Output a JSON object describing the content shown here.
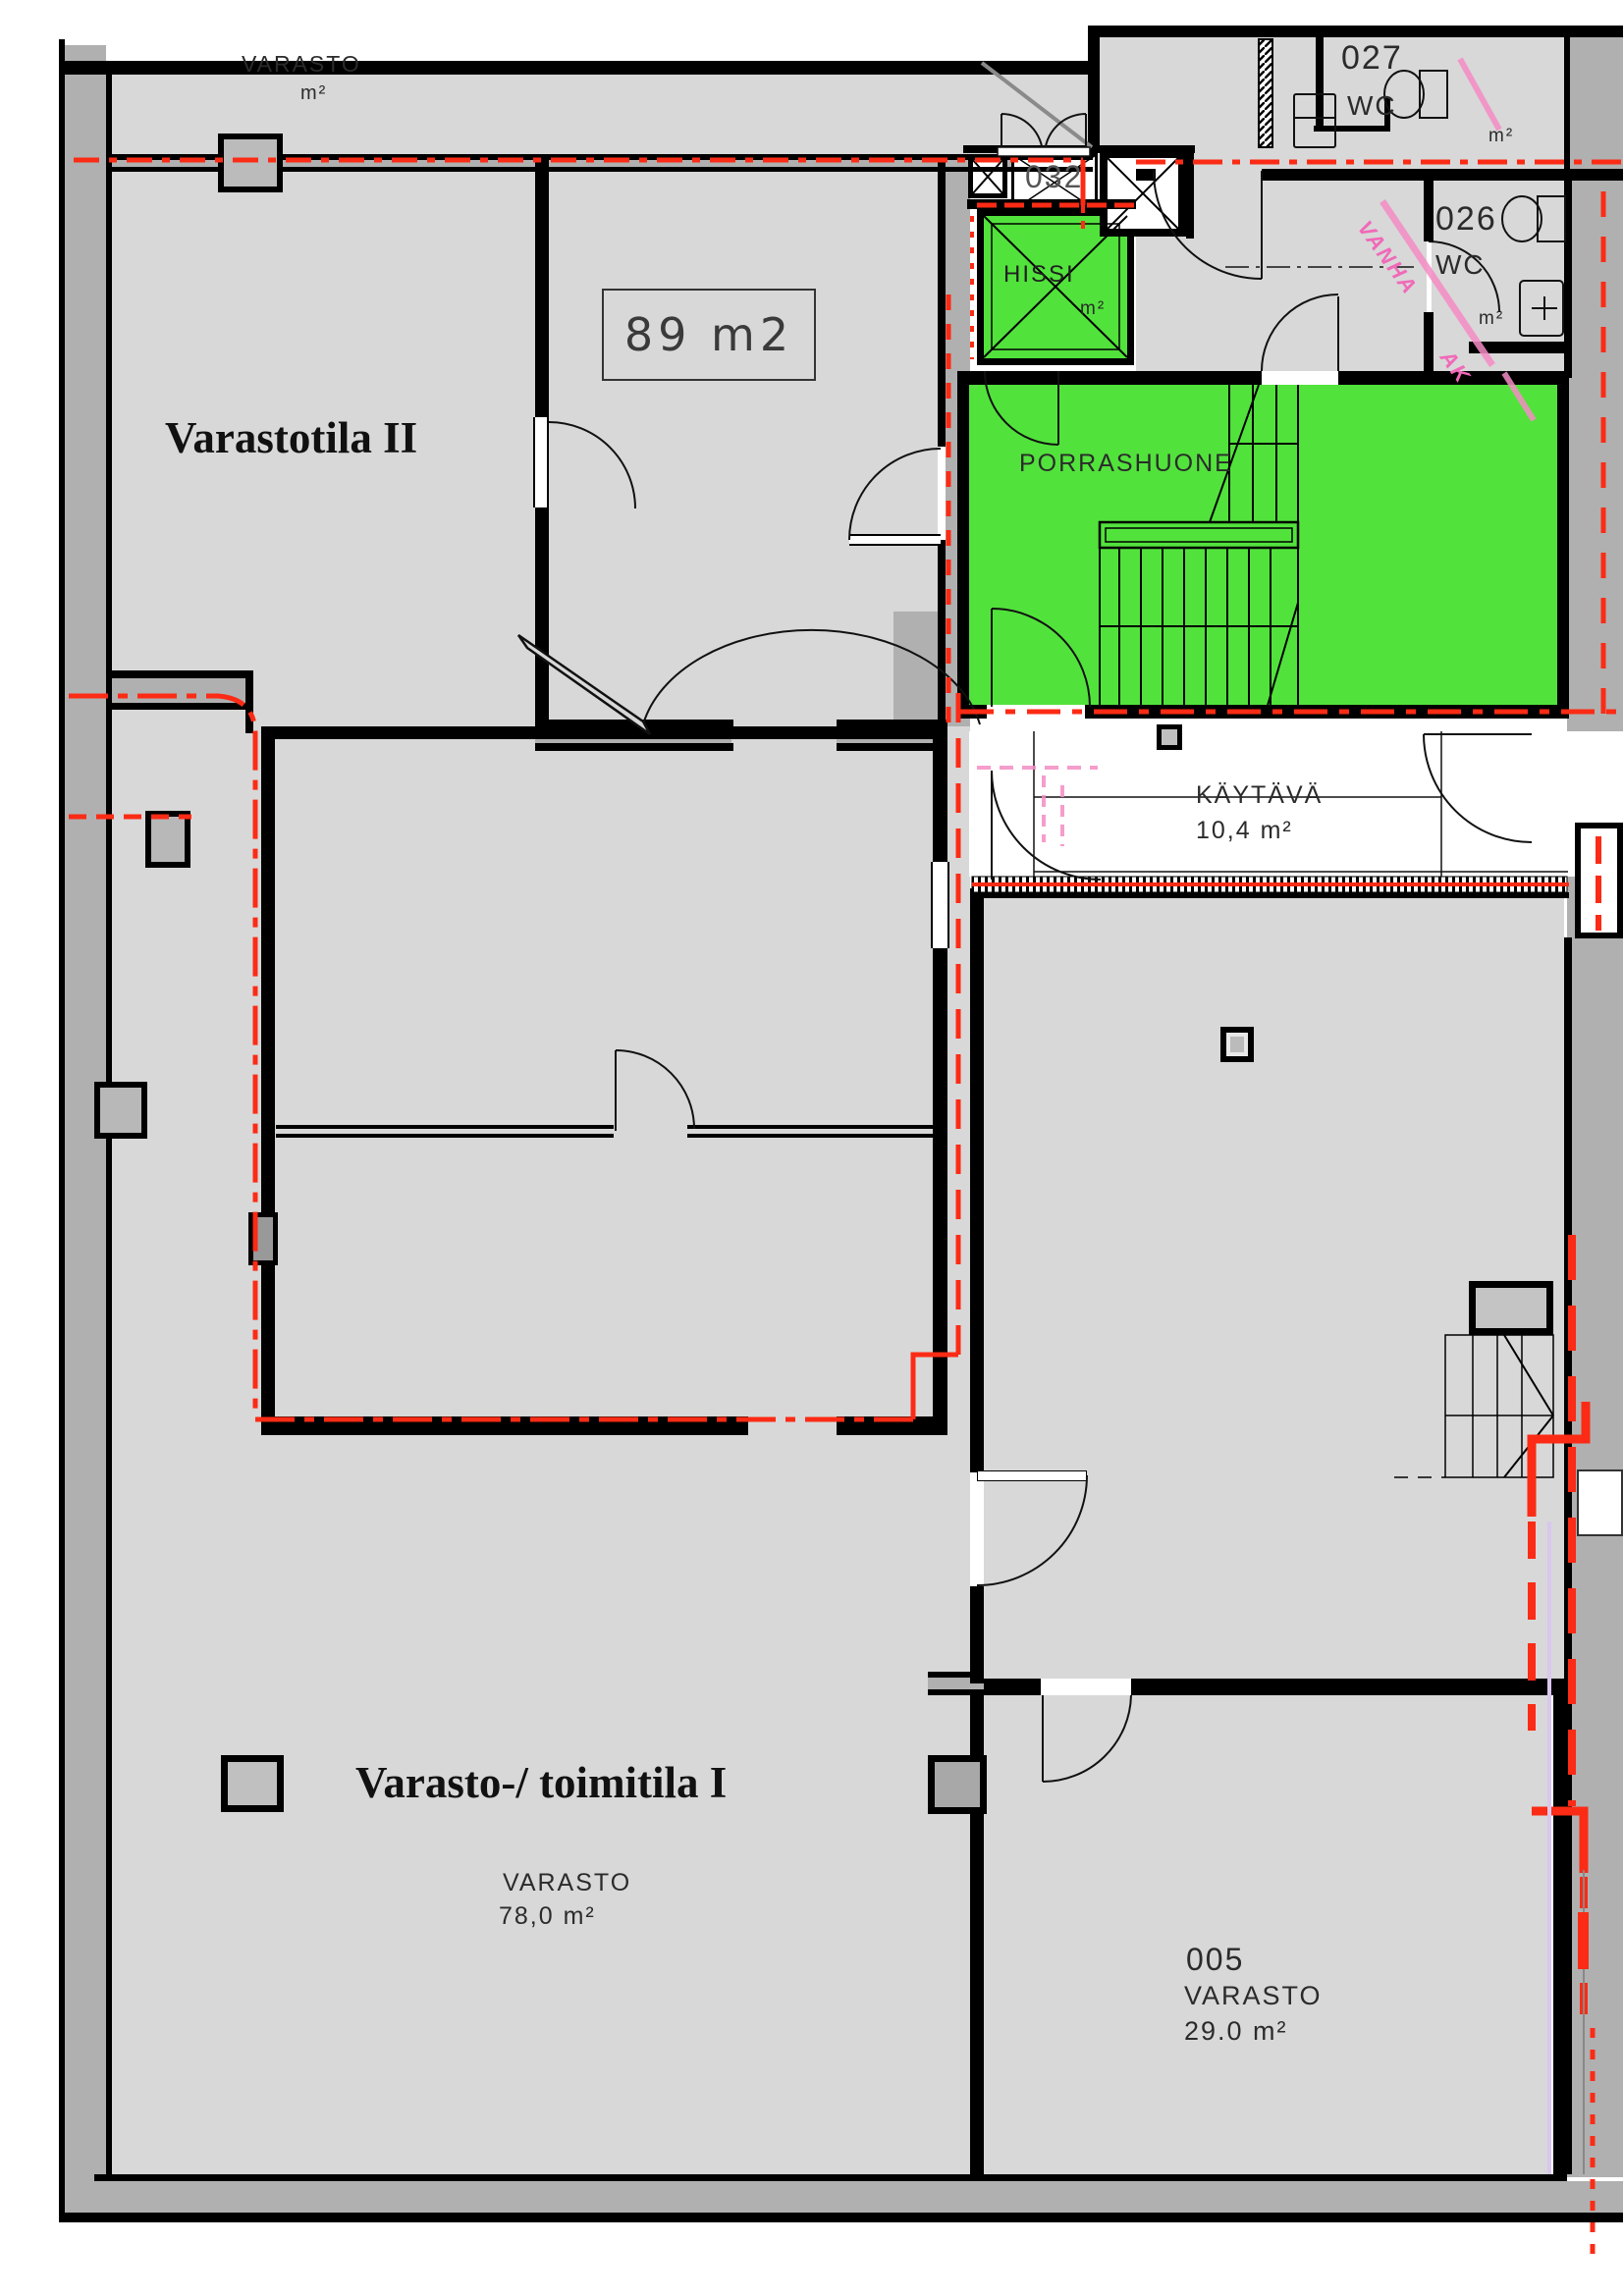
{
  "rooms": {
    "varasto_upper": {
      "name": "VARASTO",
      "area": "m²"
    },
    "varastotila_2": {
      "title": "Varastotila II"
    },
    "room_89": {
      "label": "89 m2"
    },
    "hissi": {
      "name": "HISSI",
      "area": "m²"
    },
    "porrashuone": {
      "name": "PORRASHUONE"
    },
    "room_032": {
      "number": "032"
    },
    "wc_027": {
      "number": "027",
      "type": "WC",
      "area": "m²"
    },
    "wc_026": {
      "number": "026",
      "type": "WC",
      "area": "m²"
    },
    "kaytava": {
      "name": "KÄYTÄVÄ",
      "area": "10,4  m²"
    },
    "varasto_toimitila_1": {
      "title": "Varasto-/ toimitila I"
    },
    "varasto_78": {
      "name": "VARASTO",
      "area": "78,0  m²"
    },
    "room_005": {
      "number": "005",
      "name": "VARASTO",
      "area": "29.0  m²"
    }
  },
  "annotations": {
    "handwritten_1": "VANHA",
    "handwritten_2": "AK"
  },
  "colors": {
    "highlight_green": "#52e23c",
    "fire_boundary_red": "#fb2b15",
    "annotation_pink": "#f07ab8",
    "floor_gray": "#d8d8d8",
    "wall_gray": "#b0b0b0"
  }
}
